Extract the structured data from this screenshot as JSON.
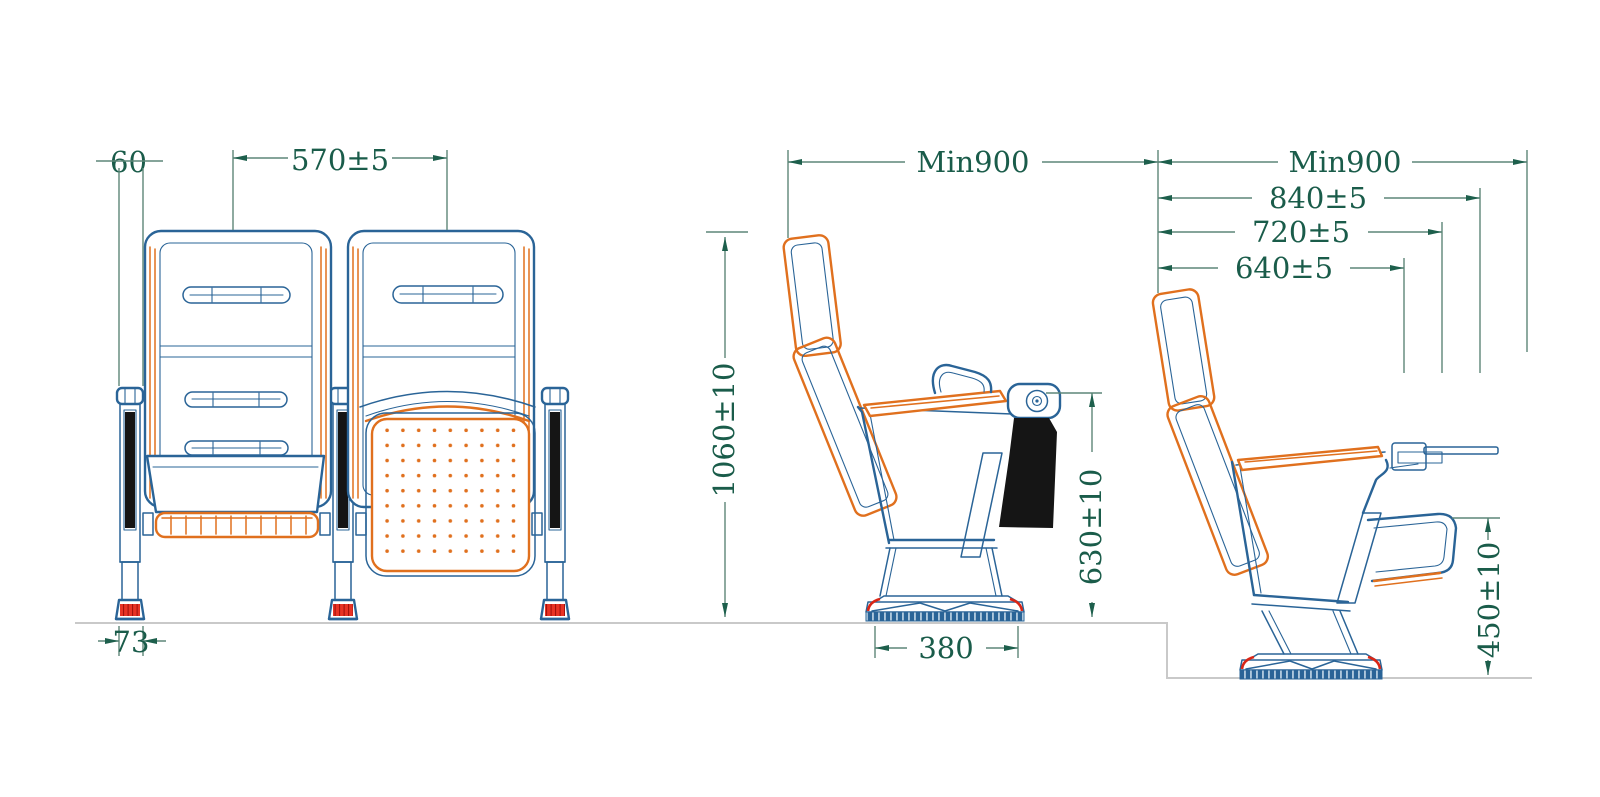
{
  "drawing": {
    "kind": "seating technical drawing, three views"
  },
  "dims": {
    "front": {
      "back_width": "60",
      "seat_spacing": "570±5",
      "foot_width": "73"
    },
    "side": {
      "row_pitch": "Min900",
      "height_overall": "1060±10",
      "height_armrest": "630±10",
      "base_depth": "380"
    },
    "tablet": {
      "row_pitch": "Min900",
      "depth_840": "840±5",
      "depth_720": "720±5",
      "depth_640": "640±5",
      "tablet_height": "450±10"
    }
  },
  "colors": {
    "outline_blue": "#2a6497",
    "accent_orange": "#e0701e",
    "dimension_green": "#1a5c4a",
    "dimension_line": "#5d8678",
    "foot_red": "#da2616",
    "pad_black": "#151515",
    "ground_gray": "#c9c9c9"
  }
}
